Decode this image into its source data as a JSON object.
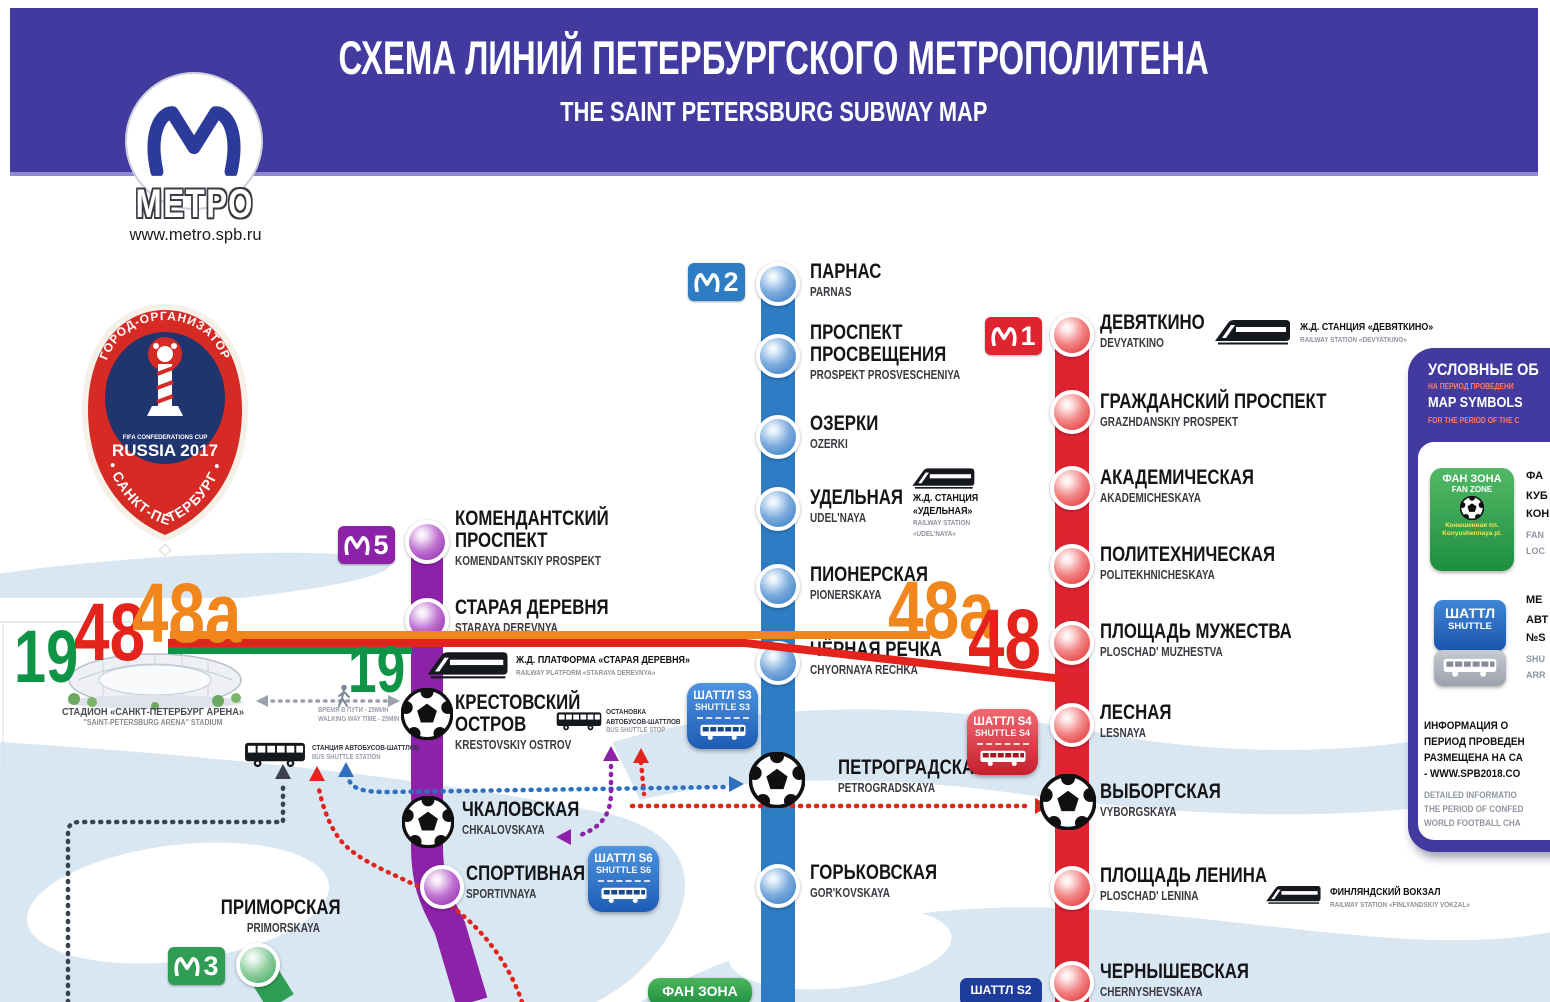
{
  "colors": {
    "banner": "#433aa0",
    "m1": "#e02330",
    "m2": "#2e7dc4",
    "m3": "#2f9e54",
    "m5": "#8d22a8",
    "river": "#d9e7f3",
    "ann_red": "#e3231c",
    "ann_green": "#0f9447",
    "ann_orange": "#f0861c",
    "navy": "#1e3c9c"
  },
  "banner": {
    "title_ru": "СХЕМА ЛИНИЙ ПЕТЕРБУРГСКОГО МЕТРОПОЛИТЕНА",
    "title_en": "THE SAINT PETERSBURG SUBWAY MAP"
  },
  "logo": {
    "caption": "МЕТРО",
    "url": "www.metro.spb.ru"
  },
  "fifa": {
    "arc_top": "ГОРОД-ОРГАНИЗАТОР",
    "cup_small": "FIFA CONFEDERATIONS CUP",
    "russia": "RUSSIA 2017",
    "arc_bottom": "• САНКТ-ПЕТЕРБУРГ •"
  },
  "lines": [
    {
      "id": "m2",
      "badge": "2",
      "badge_pos": [
        688,
        263
      ],
      "x": 778,
      "path": "M 778 284 L 778 1002",
      "width": 34,
      "stations": [
        {
          "ru": "ПАРНАС",
          "en": "PARNAS",
          "y": 284,
          "label": [
            810,
            261
          ]
        },
        {
          "ru": "ПРОСПЕКТ\nПРОСВЕЩЕНИЯ",
          "en": "PROSPEKT PROSVESCHENIYA",
          "y": 356,
          "label": [
            810,
            322
          ]
        },
        {
          "ru": "ОЗЕРКИ",
          "en": "OZERKI",
          "y": 437,
          "label": [
            810,
            413
          ]
        },
        {
          "ru": "УДЕЛЬНАЯ",
          "en": "UDEL'NAYA",
          "y": 509,
          "label": [
            810,
            487
          ]
        },
        {
          "ru": "ПИОНЕРСКАЯ",
          "en": "PIONERSKAYA",
          "y": 586,
          "label": [
            810,
            564
          ]
        },
        {
          "ru": "ЧЁРНАЯ РЕЧКА",
          "en": "CHYORNAYA RECHKA",
          "y": 663,
          "label": [
            810,
            639
          ]
        },
        {
          "ru": "ПЕТРОГРАДСКАЯ",
          "en": "PETROGRADSKAYA",
          "y": 783,
          "label": [
            838,
            757
          ],
          "ball": true
        },
        {
          "ru": "ГОРЬКОВСКАЯ",
          "en": "GOR'KOVSKAYA",
          "y": 886,
          "label": [
            810,
            862
          ]
        }
      ]
    },
    {
      "id": "m1",
      "badge": "1",
      "badge_pos": [
        985,
        317
      ],
      "x": 1072,
      "path": "M 1072 335 L 1072 1002",
      "width": 34,
      "stations": [
        {
          "ru": "ДЕВЯТКИНО",
          "en": "DEVYATKINO",
          "y": 335,
          "label": [
            1100,
            312
          ]
        },
        {
          "ru": "ГРАЖДАНСКИЙ ПРОСПЕКТ",
          "en": "GRAZHDANSKIY PROSPEKT",
          "y": 412,
          "label": [
            1100,
            391
          ]
        },
        {
          "ru": "АКАДЕМИЧЕСКАЯ",
          "en": "AKADEMICHESKAYA",
          "y": 488,
          "label": [
            1100,
            467
          ]
        },
        {
          "ru": "ПОЛИТЕХНИЧЕСКАЯ",
          "en": "POLITEKHNICHESKAYA",
          "y": 566,
          "label": [
            1100,
            544
          ]
        },
        {
          "ru": "ПЛОЩАДЬ МУЖЕСТВА",
          "en": "PLOSCHAD' MUZHESTVA",
          "y": 643,
          "label": [
            1100,
            621
          ]
        },
        {
          "ru": "ЛЕСНАЯ",
          "en": "LESNAYA",
          "y": 725,
          "label": [
            1100,
            702
          ]
        },
        {
          "ru": "ВЫБОРГСКАЯ",
          "en": "VYBORGSKAYA",
          "y": 803,
          "label": [
            1100,
            781
          ],
          "ball": true
        },
        {
          "ru": "ПЛОЩАДЬ ЛЕНИНА",
          "en": "PLOSCHAD' LENINA",
          "y": 888,
          "label": [
            1100,
            865
          ]
        },
        {
          "ru": "ЧЕРНЫШЕВСКАЯ",
          "en": "CHERNYSHEVSKAYA",
          "y": 983,
          "label": [
            1100,
            961
          ]
        }
      ]
    },
    {
      "id": "m5",
      "badge": "5",
      "badge_pos": [
        338,
        526
      ],
      "x": 427,
      "path": "M 427 545 L 427 845 C 427 888 438 903 450 928 L 472 1002",
      "width": 32,
      "stations": [
        {
          "ru": "КОМЕНДАНТСКИЙ\nПРОСПЕКТ",
          "en": "KOMENDANTSKIY PROSPEKT",
          "y": 542,
          "label": [
            455,
            508
          ]
        },
        {
          "ru": "СТАРАЯ ДЕРЕВНЯ",
          "en": "STARAYA DEREVNYA",
          "y": 620,
          "label": [
            455,
            597
          ]
        },
        {
          "ru": "КРЕСТОВСКИЙ\nОСТРОВ",
          "en": "KRESTOVSKIY OSTROV",
          "y": 715,
          "label": [
            455,
            692
          ],
          "ball": true
        },
        {
          "ru": "ЧКАЛОВСКАЯ",
          "en": "CHKALOVSKAYA",
          "y": 823,
          "label": [
            462,
            799
          ],
          "ball": true
        },
        {
          "ru": "СПОРТИВНАЯ",
          "en": "SPORTIVNAYA",
          "y": 887,
          "x": 442,
          "label": [
            466,
            863
          ]
        }
      ]
    },
    {
      "id": "m3",
      "badge": "3",
      "badge_pos": [
        168,
        947
      ],
      "x": 258,
      "path": "M 258 965 L 281 1002",
      "width": 30,
      "stations": [
        {
          "ru": "ПРИМОРСКАЯ",
          "en": "PRIMORSKAYA",
          "y": 965,
          "x": 258,
          "label": [
            196,
            897
          ],
          "align": "right",
          "label_w": 124
        }
      ]
    }
  ],
  "railway_notes": [
    {
      "icon": [
        1212,
        318,
        80
      ],
      "x": 1300,
      "y": 321,
      "ru": [
        "Ж.Д. СТАНЦИЯ «ДЕВЯТКИНО»"
      ],
      "en": [
        "RAILWAY STATION «DEVYATKINO»"
      ]
    },
    {
      "icon": [
        910,
        466,
        66
      ],
      "x": 913,
      "y": 492,
      "ru": [
        "Ж.Д. СТАНЦИЯ",
        "«УДЕЛЬНАЯ»"
      ],
      "en": [
        "RAILWAY STATION",
        "«UDEL'NAYA»"
      ]
    },
    {
      "icon": [
        424,
        650,
        86
      ],
      "x": 516,
      "y": 654,
      "ru": [
        "Ж.Д. ПЛАТФОРМА «СТАРАЯ ДЕРЕВНЯ»"
      ],
      "en": [
        "RAILWAY PLATFORM «STARAYA DEREVNYA»"
      ]
    },
    {
      "icon": [
        1264,
        884,
        58
      ],
      "x": 1330,
      "y": 886,
      "ru": [
        "ФИНЛЯНДСКИЙ ВОКЗАЛ"
      ],
      "en": [
        "RAILWAY STATION «FINLYANDSKIY VOKZAL»"
      ]
    }
  ],
  "shuttles": [
    {
      "id": "s3",
      "ru": "ШАТТЛ S3",
      "en": "SHUTTLE S3",
      "x": 687,
      "y": 683,
      "color": "blue"
    },
    {
      "id": "s4",
      "ru": "ШАТТЛ S4",
      "en": "SHUTTLE S4",
      "x": 967,
      "y": 709,
      "color": "red"
    },
    {
      "id": "s6",
      "ru": "ШАТТЛ S6",
      "en": "SHUTTLE S6",
      "x": 588,
      "y": 846,
      "color": "blue"
    }
  ],
  "s2_badge": {
    "label": "ШАТТЛ S2"
  },
  "fan_zone_bottom": {
    "label": "ФАН ЗОНА"
  },
  "stadium": {
    "ru": "СТАДИОН «САНКТ-ПЕТЕРБУРГ АРЕНА»",
    "en": "\"SAINT-PETERSBURG ARENA\" STADIUM"
  },
  "walking": {
    "ru": "ВРЕМЯ В ПУТИ - 25МИН",
    "en": "WALKING WAY TIME - 25MIN"
  },
  "bus_station": {
    "ru": "СТАНЦИЯ АВТОБУСОВ-ШАТТЛОВ",
    "en": "BUS SHUTTLE STATION"
  },
  "bus_stop": {
    "ru1": "ОСТАНОВКА",
    "ru2": "АВТОБУСОВ-ШАТТЛОВ",
    "en": "BUS SHUTTLE STOP"
  },
  "annotations": {
    "items": [
      {
        "text": "19",
        "color": "#0f9447",
        "x": 14,
        "y": 622,
        "size": 74
      },
      {
        "text": "48",
        "color": "#e3231c",
        "x": 74,
        "y": 594,
        "size": 82
      },
      {
        "text": "48a",
        "color": "#f0861c",
        "x": 132,
        "y": 574,
        "size": 84
      },
      {
        "text": "19",
        "color": "#0f9447",
        "x": 348,
        "y": 638,
        "size": 66
      },
      {
        "text": "48a",
        "color": "#f0861c",
        "x": 888,
        "y": 572,
        "size": 82
      },
      {
        "text": "48",
        "color": "#e3231c",
        "x": 968,
        "y": 600,
        "size": 84
      }
    ]
  },
  "sidebar": {
    "header_ru": "УСЛОВНЫЕ ОБ",
    "header_ru_sub": "НА ПЕРИОД ПРОВЕДЕНИ",
    "header_en": "MAP SYMBOLS",
    "header_en_sub": "FOR THE PERIOD OF THE C",
    "fan_badge": {
      "ru": "ФАН ЗОНА",
      "en": "FAN ZONE",
      "loc_ru": "Конюшенная пл.",
      "loc_en": "Konyushennaya pl."
    },
    "fan_side": [
      "ФА",
      "КУБ",
      "КОН",
      "FAN",
      "LOC"
    ],
    "shuttle_badge": {
      "ru": "ШАТТЛ",
      "en": "SHUTTLE"
    },
    "shuttle_side": [
      "МЕ",
      "АВТ",
      "№S",
      "SHU",
      "ARR"
    ],
    "info_ru": [
      "ИНФОРМАЦИЯ О",
      "ПЕРИОД ПРОВЕДЕН",
      "РАЗМЕЩЕНА НА СА",
      "- WWW.SPB2018.CO"
    ],
    "info_en": [
      "DETAILED INFORMATIO",
      "THE PERIOD OF CONFED",
      "WORLD FOOTBALL CHA"
    ]
  }
}
